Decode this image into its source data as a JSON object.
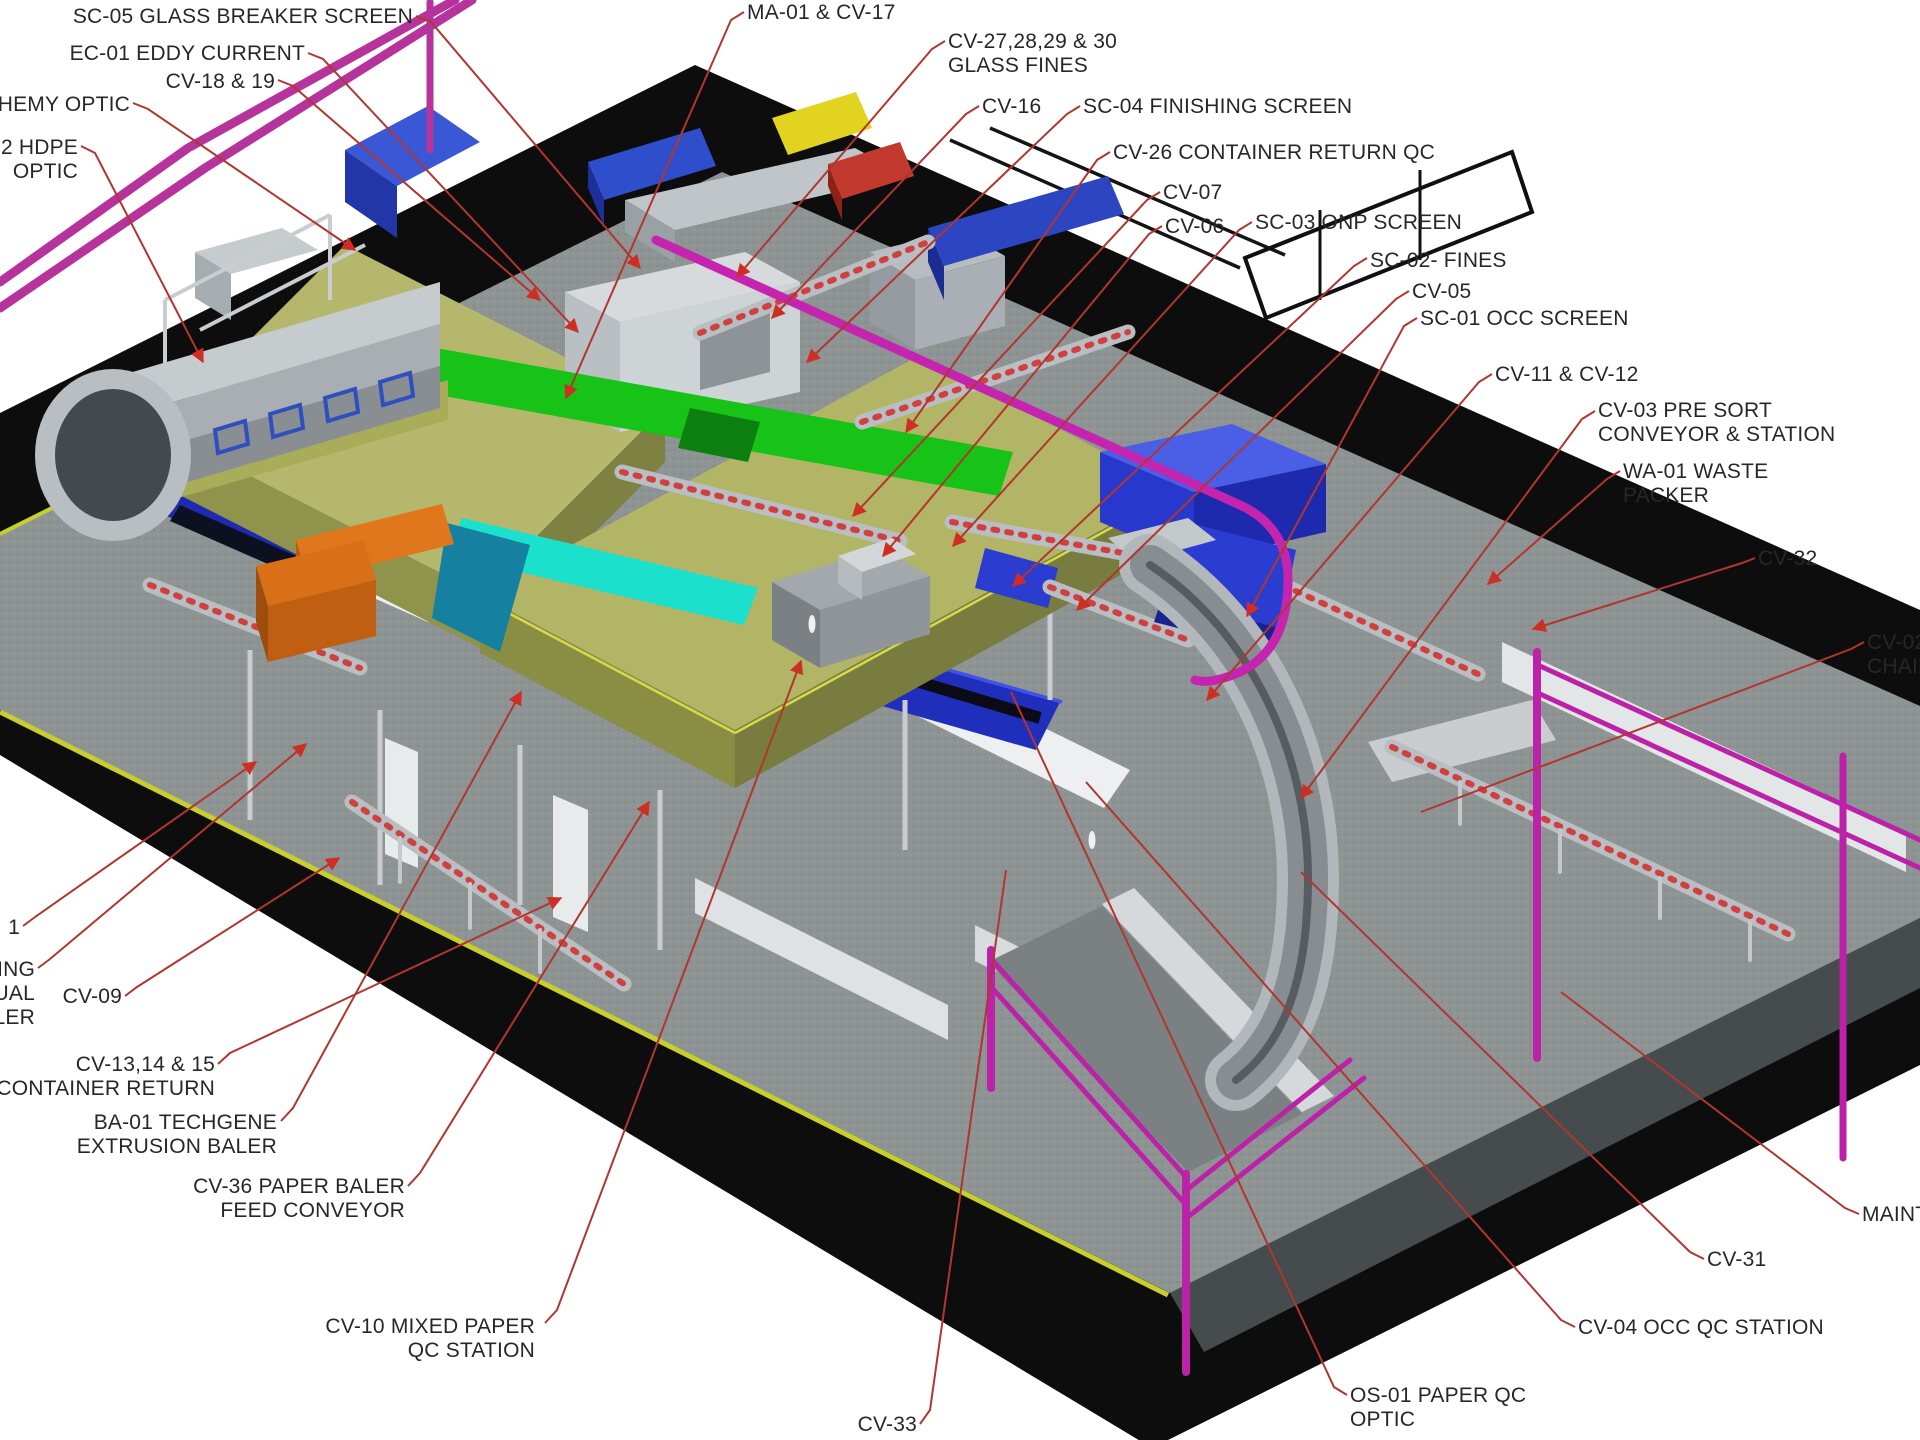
{
  "scene": {
    "width": 1920,
    "height": 1440,
    "background": "#ffffff",
    "description_visible_type": "isometric facility equipment layout rendering with red leader callouts"
  },
  "palette": {
    "slab_black": "#0d0d0e",
    "floor_gray": "#8e9394",
    "floor_edge_band": "#464b4e",
    "edge_stripe_yellow": "#c9ce2f",
    "leader_red": "#b0362f",
    "arrow_red": "#cf2e24",
    "label_text": "#272727",
    "pipe_magenta": "#b5339b",
    "mezzanine_olive": "#b5b86c",
    "belt_green": "#16c316",
    "belt_cyan": "#1ae0cc",
    "teal_machine": "#15809f",
    "royal_blue": "#2a3dd0",
    "navy_belt": "#1e2bb0",
    "orange_machine": "#d96f17",
    "machine_gray": "#c6cbce",
    "wall_white": "#edeff0"
  },
  "callouts": [
    {
      "id": "sc05",
      "align": "right",
      "x": 413,
      "y": 5,
      "lines": [
        "SC-05 GLASS BREAKER SCREEN"
      ],
      "path": [
        [
          416,
          16
        ],
        [
          431,
          22
        ],
        [
          640,
          268
        ]
      ],
      "arrow": true
    },
    {
      "id": "ec01",
      "align": "right",
      "x": 305,
      "y": 42,
      "lines": [
        "EC-01 EDDY CURRENT"
      ],
      "path": [
        [
          308,
          53
        ],
        [
          323,
          59
        ],
        [
          578,
          332
        ]
      ],
      "arrow": true
    },
    {
      "id": "cv18-19",
      "align": "right",
      "x": 275,
      "y": 70,
      "lines": [
        "CV-18 & 19"
      ],
      "path": [
        [
          278,
          80
        ],
        [
          293,
          86
        ],
        [
          540,
          300
        ]
      ],
      "arrow": true
    },
    {
      "id": "alchemy-optic",
      "align": "right",
      "x": 130,
      "y": 93,
      "lines": [
        "HEMY OPTIC"
      ],
      "path": [
        [
          133,
          103
        ],
        [
          148,
          109
        ],
        [
          355,
          250
        ]
      ],
      "arrow": true
    },
    {
      "id": "hdpe-optic",
      "align": "right",
      "x": 78,
      "y": 136,
      "lines": [
        "2 HDPE",
        "OPTIC"
      ],
      "path": [
        [
          81,
          146
        ],
        [
          95,
          153
        ],
        [
          203,
          362
        ]
      ],
      "arrow": true
    },
    {
      "id": "ma01-cv17",
      "align": "left",
      "x": 747,
      "y": 1,
      "lines": [
        "MA-01 & CV-17"
      ],
      "path": [
        [
          744,
          12
        ],
        [
          731,
          20
        ],
        [
          566,
          398
        ]
      ],
      "arrow": true
    },
    {
      "id": "cv27-30",
      "align": "left",
      "x": 948,
      "y": 30,
      "lines": [
        "CV-27,28,29 & 30",
        "GLASS FINES"
      ],
      "path": [
        [
          945,
          41
        ],
        [
          932,
          49
        ],
        [
          737,
          277
        ]
      ],
      "arrow": true
    },
    {
      "id": "cv16",
      "align": "left",
      "x": 982,
      "y": 95,
      "lines": [
        "CV-16"
      ],
      "path": [
        [
          979,
          106
        ],
        [
          966,
          114
        ],
        [
          772,
          318
        ]
      ],
      "arrow": true
    },
    {
      "id": "sc04",
      "align": "left",
      "x": 1083,
      "y": 95,
      "lines": [
        "SC-04 FINISHING SCREEN"
      ],
      "path": [
        [
          1080,
          106
        ],
        [
          1067,
          114
        ],
        [
          807,
          362
        ]
      ],
      "arrow": true
    },
    {
      "id": "cv26",
      "align": "left",
      "x": 1113,
      "y": 141,
      "lines": [
        "CV-26 CONTAINER RETURN QC"
      ],
      "path": [
        [
          1110,
          152
        ],
        [
          1097,
          160
        ],
        [
          906,
          432
        ]
      ],
      "arrow": true
    },
    {
      "id": "cv07",
      "align": "left",
      "x": 1163,
      "y": 181,
      "lines": [
        "CV-07"
      ],
      "path": [
        [
          1160,
          192
        ],
        [
          1147,
          200
        ],
        [
          853,
          516
        ]
      ],
      "arrow": true
    },
    {
      "id": "cv06",
      "align": "left",
      "x": 1165,
      "y": 215,
      "lines": [
        "CV-06"
      ],
      "path": [
        [
          1162,
          226
        ],
        [
          1149,
          234
        ],
        [
          883,
          556
        ]
      ],
      "arrow": true
    },
    {
      "id": "sc03",
      "align": "left",
      "x": 1255,
      "y": 211,
      "lines": [
        "SC-03 ONP SCREEN"
      ],
      "path": [
        [
          1252,
          222
        ],
        [
          1239,
          230
        ],
        [
          953,
          546
        ]
      ],
      "arrow": true
    },
    {
      "id": "sc02",
      "align": "left",
      "x": 1370,
      "y": 249,
      "lines": [
        "SC-02- FINES"
      ],
      "path": [
        [
          1367,
          258
        ],
        [
          1354,
          266
        ],
        [
          1013,
          586
        ]
      ],
      "arrow": true
    },
    {
      "id": "cv05",
      "align": "left",
      "x": 1412,
      "y": 280,
      "lines": [
        "CV-05"
      ],
      "path": [
        [
          1409,
          291
        ],
        [
          1396,
          299
        ],
        [
          1077,
          610
        ]
      ],
      "arrow": true
    },
    {
      "id": "sc01",
      "align": "left",
      "x": 1420,
      "y": 307,
      "lines": [
        "SC-01 OCC SCREEN"
      ],
      "path": [
        [
          1417,
          318
        ],
        [
          1404,
          326
        ],
        [
          1247,
          616
        ]
      ],
      "arrow": true
    },
    {
      "id": "cv11-cv12",
      "align": "left",
      "x": 1495,
      "y": 363,
      "lines": [
        "CV-11 & CV-12"
      ],
      "path": [
        [
          1492,
          374
        ],
        [
          1479,
          382
        ],
        [
          1207,
          700
        ]
      ],
      "arrow": true
    },
    {
      "id": "cv03",
      "align": "left",
      "x": 1598,
      "y": 399,
      "lines": [
        "CV-03 PRE SORT",
        "CONVEYOR & STATION"
      ],
      "path": [
        [
          1595,
          411
        ],
        [
          1582,
          419
        ],
        [
          1301,
          798
        ]
      ],
      "arrow": true
    },
    {
      "id": "wa01",
      "align": "left",
      "x": 1623,
      "y": 460,
      "lines": [
        "WA-01 WASTE",
        "PACKER"
      ],
      "path": [
        [
          1620,
          471
        ],
        [
          1607,
          479
        ],
        [
          1488,
          584
        ]
      ],
      "arrow": true
    },
    {
      "id": "cv32",
      "align": "left",
      "x": 1758,
      "y": 547,
      "lines": [
        "CV-32"
      ],
      "path": [
        [
          1755,
          558
        ],
        [
          1742,
          563
        ],
        [
          1533,
          629
        ]
      ],
      "arrow": true
    },
    {
      "id": "cv02-chain",
      "align": "left",
      "x": 1867,
      "y": 631,
      "lines": [
        "CV-02",
        "CHAIN"
      ],
      "path": [
        [
          1864,
          642
        ],
        [
          1851,
          649
        ],
        [
          1421,
          812
        ]
      ],
      "arrow": false
    },
    {
      "id": "maintenance",
      "align": "left",
      "x": 1862,
      "y": 1203,
      "lines": [
        "MAINT"
      ],
      "path": [
        [
          1859,
          1214
        ],
        [
          1845,
          1208
        ],
        [
          1561,
          992
        ]
      ],
      "arrow": false
    },
    {
      "id": "cv31",
      "align": "left",
      "x": 1707,
      "y": 1248,
      "lines": [
        "CV-31"
      ],
      "path": [
        [
          1704,
          1259
        ],
        [
          1690,
          1252
        ],
        [
          1301,
          872
        ]
      ],
      "arrow": false
    },
    {
      "id": "cv04",
      "align": "left",
      "x": 1578,
      "y": 1316,
      "lines": [
        "CV-04 OCC QC STATION"
      ],
      "path": [
        [
          1575,
          1327
        ],
        [
          1561,
          1320
        ],
        [
          1086,
          782
        ]
      ],
      "arrow": false
    },
    {
      "id": "os01",
      "align": "left",
      "x": 1350,
      "y": 1384,
      "lines": [
        "OS-01 PAPER QC",
        "OPTIC"
      ],
      "path": [
        [
          1347,
          1395
        ],
        [
          1334,
          1387
        ],
        [
          1011,
          692
        ]
      ],
      "arrow": false
    },
    {
      "id": "cv33",
      "align": "right",
      "x": 917,
      "y": 1413,
      "lines": [
        "CV-33"
      ],
      "path": [
        [
          920,
          1424
        ],
        [
          930,
          1410
        ],
        [
          1006,
          870
        ]
      ],
      "arrow": false
    },
    {
      "id": "cv10",
      "align": "right",
      "x": 535,
      "y": 1315,
      "lines": [
        "CV-10 MIXED PAPER",
        "QC STATION"
      ],
      "path": [
        [
          545,
          1323
        ],
        [
          557,
          1310
        ],
        [
          801,
          661
        ]
      ],
      "arrow": true
    },
    {
      "id": "cv36",
      "align": "right",
      "x": 405,
      "y": 1175,
      "lines": [
        "CV-36 PAPER BALER",
        "FEED CONVEYOR"
      ],
      "path": [
        [
          408,
          1186
        ],
        [
          420,
          1173
        ],
        [
          649,
          802
        ]
      ],
      "arrow": true
    },
    {
      "id": "ba01",
      "align": "right",
      "x": 277,
      "y": 1111,
      "lines": [
        "BA-01 TECHGENE",
        "EXTRUSION BALER"
      ],
      "path": [
        [
          281,
          1121
        ],
        [
          293,
          1108
        ],
        [
          521,
          692
        ]
      ],
      "arrow": true
    },
    {
      "id": "cv13-15",
      "align": "right",
      "x": 215,
      "y": 1053,
      "lines": [
        "CV-13,14 & 15",
        "CONTAINER RETURN"
      ],
      "path": [
        [
          218,
          1064
        ],
        [
          230,
          1053
        ],
        [
          561,
          898
        ]
      ],
      "arrow": true
    },
    {
      "id": "cv09",
      "align": "right",
      "x": 122,
      "y": 985,
      "lines": [
        "CV-09"
      ],
      "path": [
        [
          125,
          996
        ],
        [
          137,
          987
        ],
        [
          339,
          858
        ]
      ],
      "arrow": true
    },
    {
      "id": "edge-fragment-1",
      "align": "right",
      "x": 20,
      "y": 916,
      "lines": [
        "1"
      ],
      "path": [
        [
          23,
          926
        ],
        [
          35,
          917
        ],
        [
          256,
          762
        ]
      ],
      "arrow": true
    },
    {
      "id": "edge-fragment-baler",
      "align": "right",
      "x": 35,
      "y": 958,
      "lines": [
        "ING",
        "UAL",
        "LER"
      ],
      "path": [
        [
          38,
          968
        ],
        [
          50,
          959
        ],
        [
          306,
          744
        ]
      ],
      "arrow": true
    }
  ]
}
